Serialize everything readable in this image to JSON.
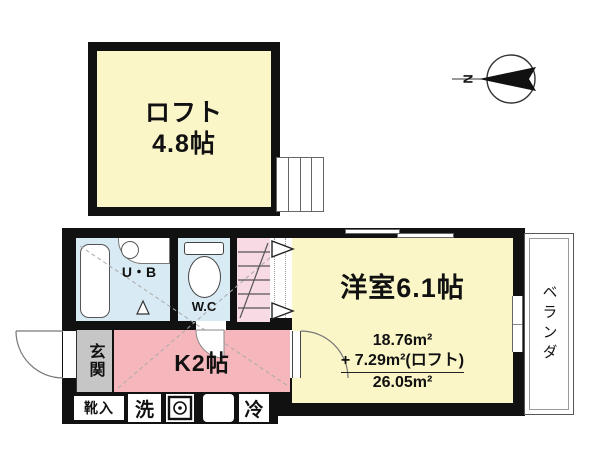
{
  "compass": {
    "north": "N"
  },
  "loft": {
    "name": "ロフト",
    "size": "4.8帖"
  },
  "unit_bath": {
    "label": "U・B"
  },
  "wc": {
    "label": "W.C"
  },
  "western_room": {
    "label": "洋室6.1帖",
    "area_main": "18.76m²",
    "area_loft": "+ 7.29m²(ロフト)",
    "area_total": "26.05m²"
  },
  "entrance": {
    "label": "玄関"
  },
  "kitchen": {
    "label": "K2帖"
  },
  "veranda": {
    "label": "ベランダ"
  },
  "fixtures": {
    "shoe_box": "靴入",
    "washer": "洗",
    "fridge": "冷"
  },
  "colors": {
    "wall": "#111111",
    "room_yellow": "#FAF6C8",
    "kitchen_pink": "#F5B7BC",
    "stairs_pink": "#F7DAE3",
    "water_blue": "#D8EAF3",
    "entrance_gray": "#C6C6C6"
  }
}
